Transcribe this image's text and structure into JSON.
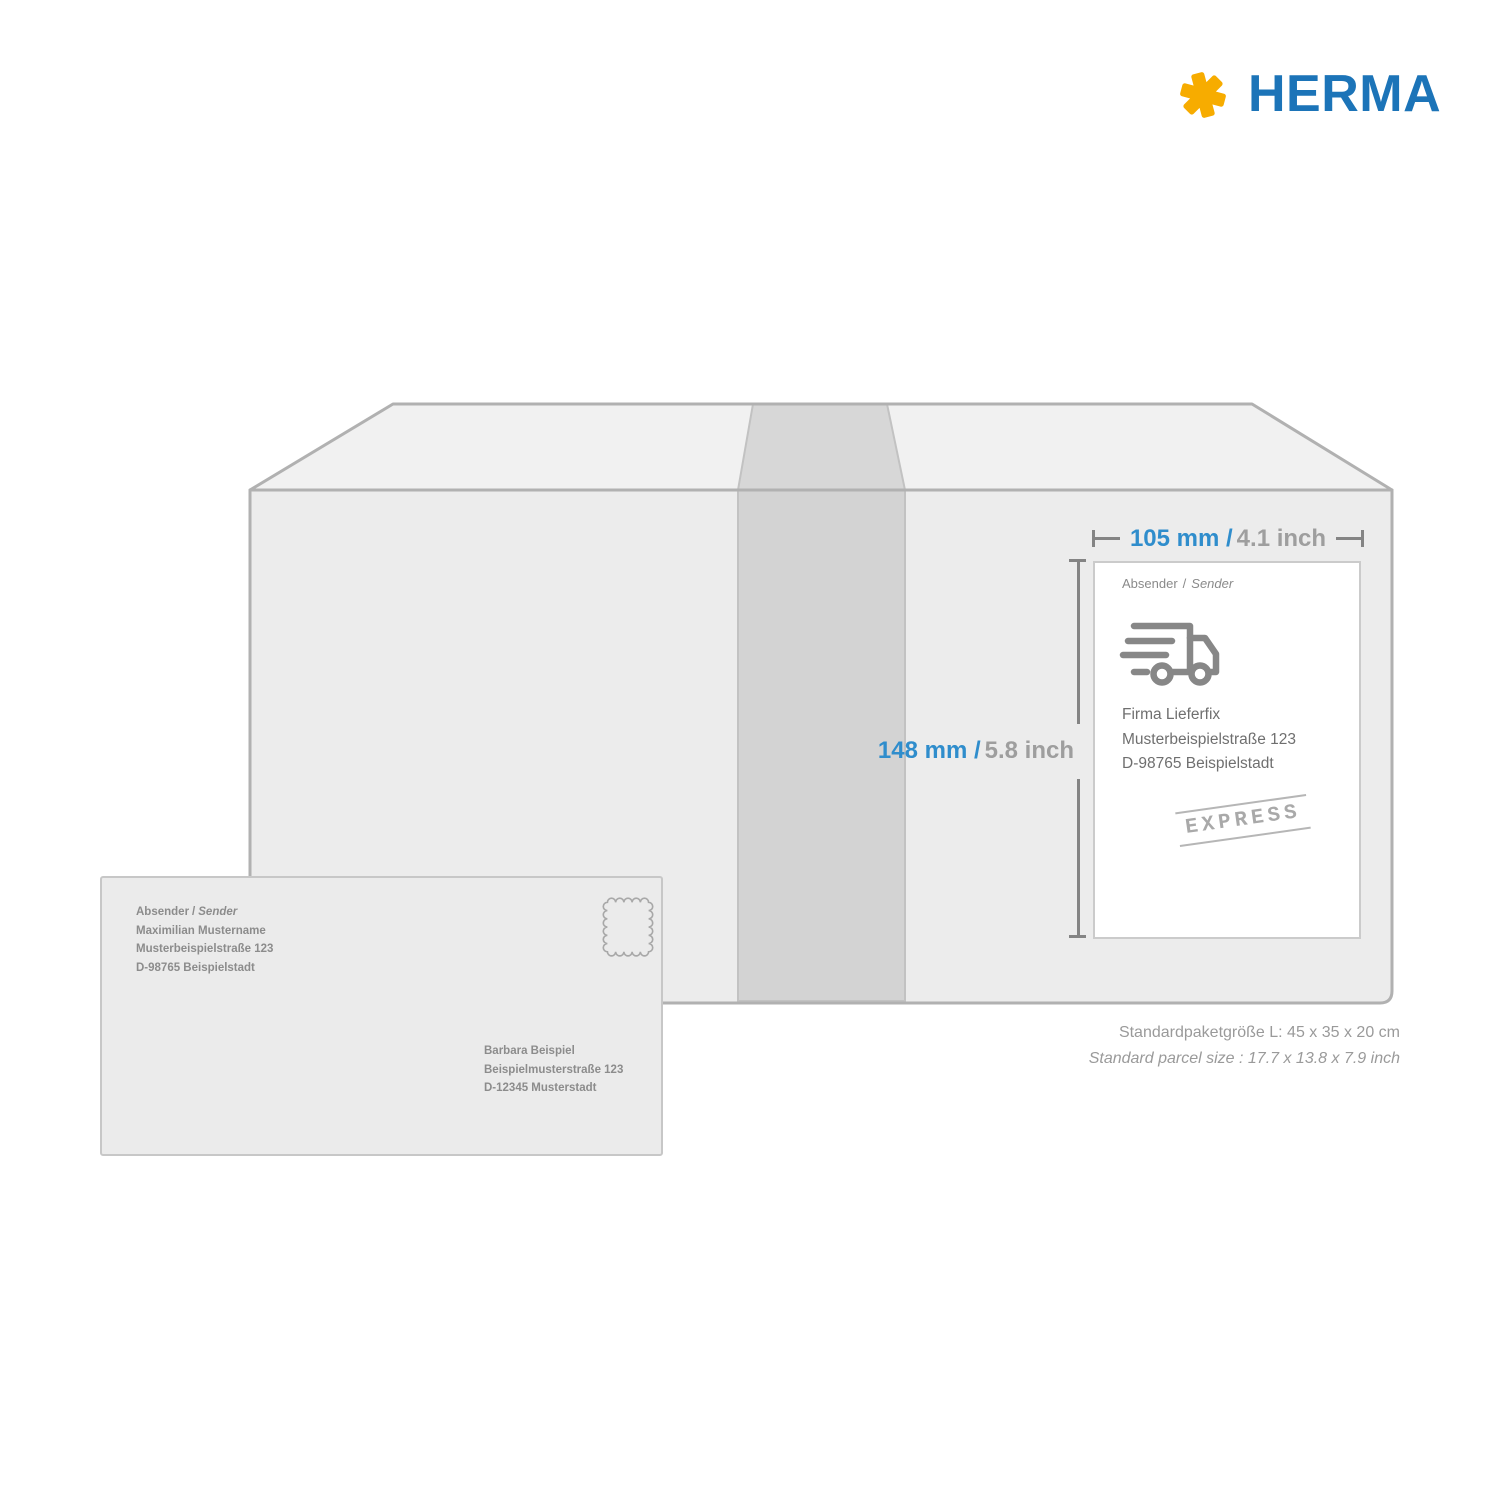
{
  "brand": {
    "name": "HERMA",
    "star_icon": "herma-star-icon"
  },
  "annotations": {
    "width_metric": "105 mm /",
    "width_imperial": "4.1 inch",
    "height_metric": "148 mm /",
    "height_imperial": "5.8 inch"
  },
  "parcel_label": {
    "sender_caption_de": "Absender",
    "sender_caption_sep": "/",
    "sender_caption_en": "Sender",
    "truck_icon": "delivery-truck-icon",
    "address_lines": [
      "Firma Lieferfix",
      "Musterbeispielstraße 123",
      "D-98765 Beispielstadt"
    ],
    "express_stamp": "EXPRESS"
  },
  "envelope": {
    "sender_caption_de": "Absender",
    "sender_caption_sep": "/",
    "sender_caption_en": "Sender",
    "stamp_icon": "postage-stamp-icon",
    "sender_lines": [
      "Maximilian Mustername",
      "Musterbeispielstraße 123",
      "D-98765 Beispielstadt"
    ],
    "recipient_lines": [
      "Barbara Beispiel",
      "Beispielmusterstraße 123",
      "D-12345 Musterstadt"
    ]
  },
  "footnote": {
    "metric": "Standardpaketgröße L: 45 x 35 x 20 cm",
    "imperial": "Standard parcel size : 17.7 x 13.8 x 7.9 inch"
  },
  "colors": {
    "brand_blue": "#1C74B8",
    "brand_yellow": "#F7AC00",
    "dim_blue": "#2F8DCC",
    "dim_gray": "#9E9E9E"
  }
}
